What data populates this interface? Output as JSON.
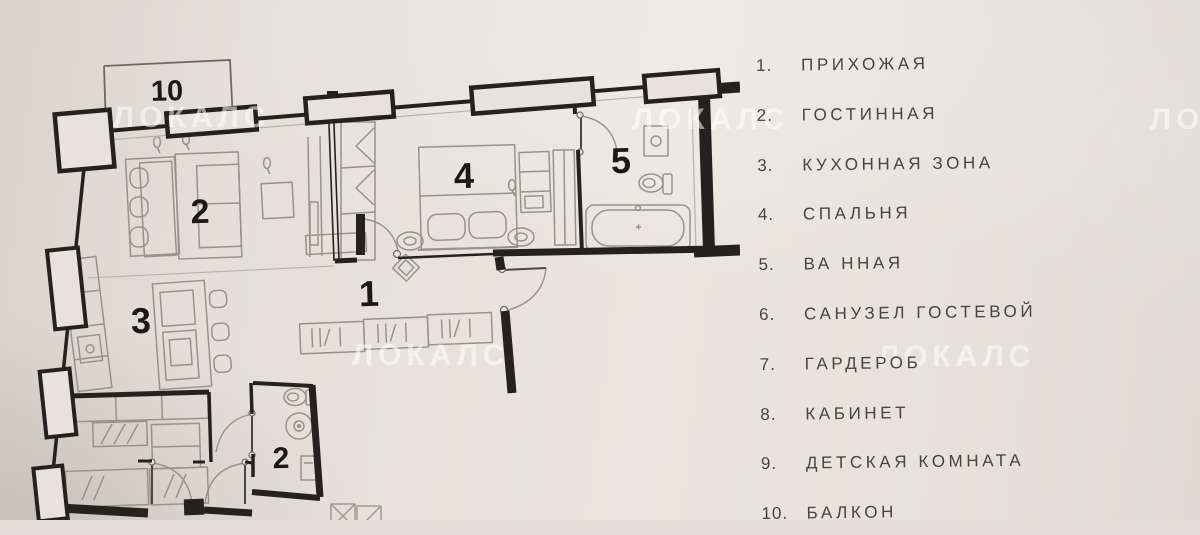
{
  "photo": {
    "watermark_text": "ЛОКАЛС"
  },
  "plan": {
    "room_labels": [
      {
        "id": "10",
        "x": 167,
        "y": 92,
        "size": 29
      },
      {
        "id": "2",
        "x": 200,
        "y": 212,
        "size": 34
      },
      {
        "id": "4",
        "x": 464,
        "y": 176,
        "size": 36
      },
      {
        "id": "5",
        "x": 621,
        "y": 161,
        "size": 36
      },
      {
        "id": "1",
        "x": 369,
        "y": 294,
        "size": 36
      },
      {
        "id": "3",
        "x": 141,
        "y": 321,
        "size": 36
      },
      {
        "id": "2",
        "x": 281,
        "y": 459,
        "size": 30
      }
    ]
  },
  "legend": {
    "items": [
      {
        "num": "1.",
        "label": "ПРИХОЖАЯ"
      },
      {
        "num": "2.",
        "label": "ГОСТИННАЯ"
      },
      {
        "num": "3.",
        "label": "КУХОННАЯ ЗОНА"
      },
      {
        "num": "4.",
        "label": "СПАЛЬНЯ"
      },
      {
        "num": "5.",
        "label": "ВА ННАЯ"
      },
      {
        "num": "6.",
        "label": "САНУЗЕЛ ГОСТЕВОЙ"
      },
      {
        "num": "7.",
        "label": "ГАРДЕРОБ"
      },
      {
        "num": "8.",
        "label": "КАБИНЕТ"
      },
      {
        "num": "9.",
        "label": "ДЕТСКАЯ КОМНАТА"
      },
      {
        "num": "10.",
        "label": "БАЛКОН"
      }
    ]
  },
  "colors": {
    "paper": "#e7e3dc",
    "wall": "#24221e",
    "furniture": "#98938a",
    "label_text": "#1b1916",
    "legend_text": "#474540",
    "watermark": "#ffffff"
  }
}
